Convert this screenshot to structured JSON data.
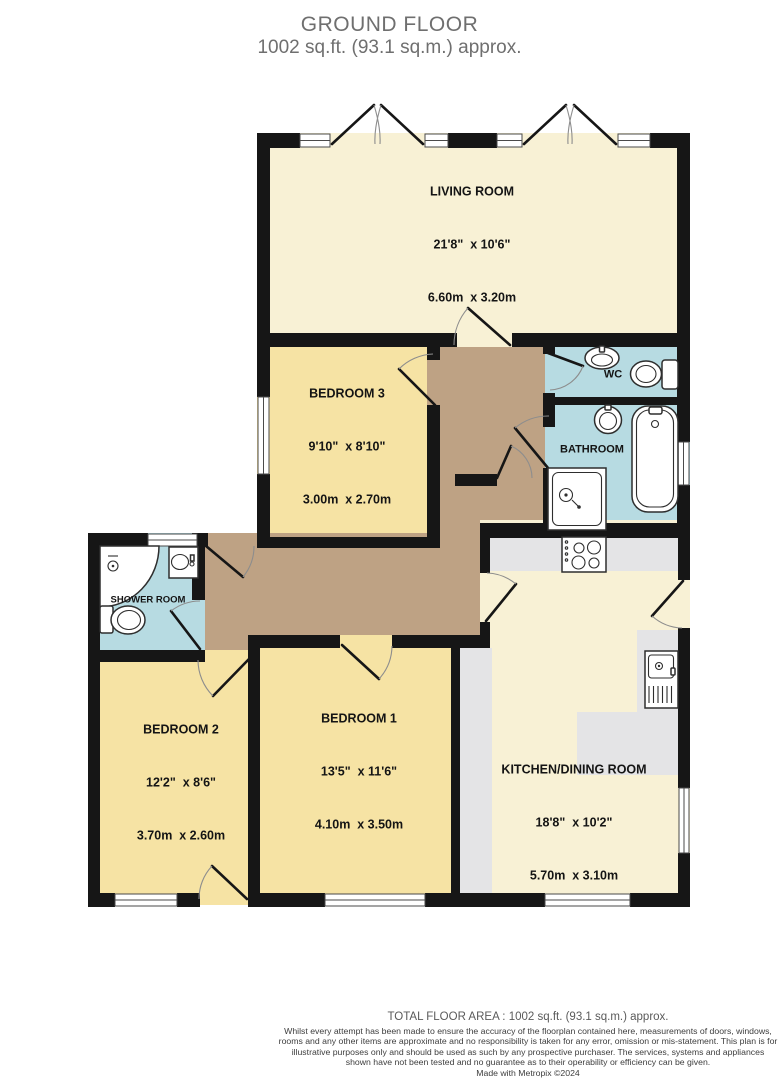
{
  "title": {
    "line1": "GROUND FLOOR",
    "line2": "1002 sq.ft. (93.1 sq.m.) approx."
  },
  "rooms": {
    "living_room": {
      "name": "LIVING ROOM",
      "imperial": "21'8\"  x 10'6\"",
      "metric": "6.60m  x 3.20m"
    },
    "bedroom_3": {
      "name": "BEDROOM 3",
      "imperial": "9'10\"  x 8'10\"",
      "metric": "3.00m  x 2.70m"
    },
    "bedroom_2": {
      "name": "BEDROOM 2",
      "imperial": "12'2\"  x 8'6\"",
      "metric": "3.70m  x 2.60m"
    },
    "bedroom_1": {
      "name": "BEDROOM 1",
      "imperial": "13'5\"  x 11'6\"",
      "metric": "4.10m  x 3.50m"
    },
    "kitchen": {
      "name": "KITCHEN/DINING ROOM",
      "imperial": "18'8\"  x 10'2\"",
      "metric": "5.70m  x 3.10m"
    },
    "wc": {
      "name": "WC"
    },
    "bathroom": {
      "name": "BATHROOM"
    },
    "shower_room": {
      "name": "SHOWER ROOM"
    }
  },
  "footer": {
    "total": "TOTAL FLOOR AREA : 1002 sq.ft. (93.1 sq.m.) approx.",
    "disclaimer": "Whilst every attempt has been made to ensure the accuracy of the floorplan contained here, measurements of doors, windows, rooms and any other items are approximate and no responsibility is taken for any error, omission or mis-statement. This plan is for illustrative purposes only and should be used as such by any prospective purchaser. The services, systems and appliances shown have not been tested and no guarantee as to their operability or efficiency can be given.",
    "credit": "Made with Metropix ©2024"
  },
  "colors": {
    "wall": "#161616",
    "cream": "#F8F1D5",
    "yellow": "#F6E3A4",
    "blue": "#B7DBE2",
    "tan": "#BEA284",
    "counter": "#E4E4E6",
    "titlegray": "#6f6f6f"
  }
}
